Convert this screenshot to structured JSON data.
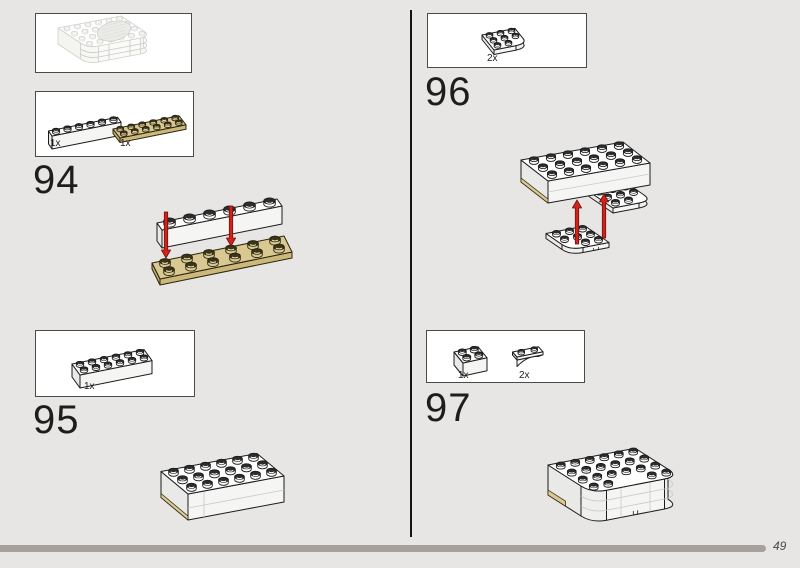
{
  "page": {
    "number": "49"
  },
  "progress": {
    "fraction": 0.957
  },
  "colors": {
    "background": "#e7e6e4",
    "progress_bar": "#a8a19b",
    "arrow_red": "#d0231a",
    "tan": "#dac893",
    "white_piece": "#ffffff",
    "outline": "#1c1c1c"
  },
  "preview": {
    "description": "ghost outline of assembled model with speaker grille"
  },
  "steps": [
    {
      "id": "94",
      "parts": [
        {
          "count": "1x",
          "piece": "brick-1x6-white"
        },
        {
          "count": "1x",
          "piece": "plate-2x6-tan"
        }
      ],
      "figure": "brick placed onto tan plate, two red arrows down"
    },
    {
      "id": "95",
      "parts": [
        {
          "count": "1x",
          "piece": "brick-2x6-white"
        }
      ],
      "figure": "white block assembly with tan plate edge"
    },
    {
      "id": "96",
      "parts": [
        {
          "count": "2x",
          "piece": "plate-3x3-round-corner-white"
        }
      ],
      "figure": "round corner plates attached under block, two red arrows up"
    },
    {
      "id": "97",
      "parts": [
        {
          "count": "1x",
          "piece": "brick-2x2-white"
        },
        {
          "count": "2x",
          "piece": "arch-1x3-white"
        }
      ],
      "figure": "rounded block assembly with tan plate edge"
    }
  ]
}
